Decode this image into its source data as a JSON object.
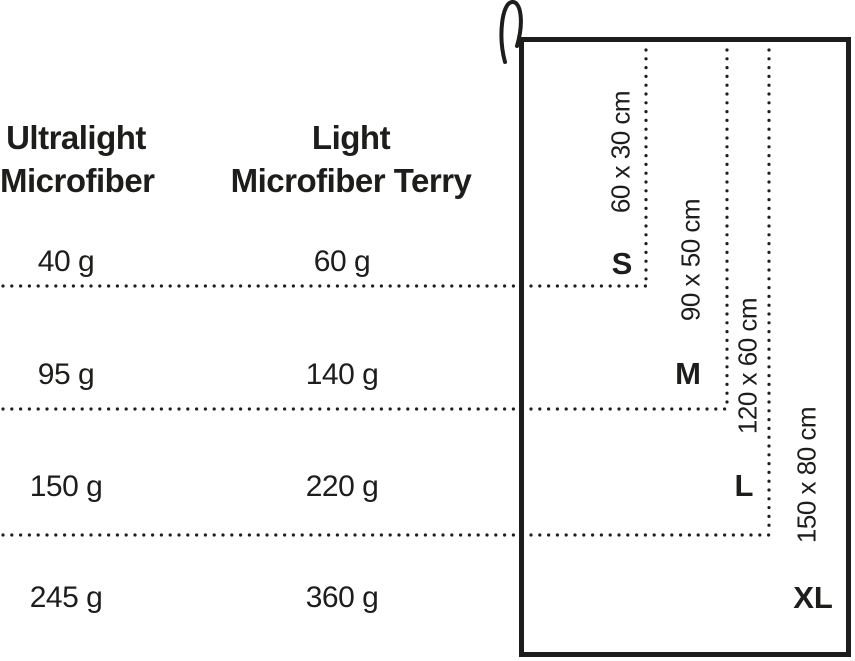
{
  "title": "Towel size and weight comparison",
  "colors": {
    "ink": "#1d1d1b",
    "background": "#ffffff"
  },
  "table": {
    "columns": [
      {
        "line1": "Ultralight",
        "line2": "Microfiber"
      },
      {
        "line1": "Light",
        "line2": "Microfiber Terry"
      }
    ],
    "rows": [
      {
        "size": "S",
        "dimensions": "60 x 30 cm",
        "col1": "40 g",
        "col2": "60 g"
      },
      {
        "size": "M",
        "dimensions": "90 x 50 cm",
        "col1": "95 g",
        "col2": "140 g"
      },
      {
        "size": "L",
        "dimensions": "120 x 60 cm",
        "col1": "150 g",
        "col2": "220 g"
      },
      {
        "size": "XL",
        "dimensions": "150 x 80 cm",
        "col1": "245 g",
        "col2": "360 g"
      }
    ]
  }
}
